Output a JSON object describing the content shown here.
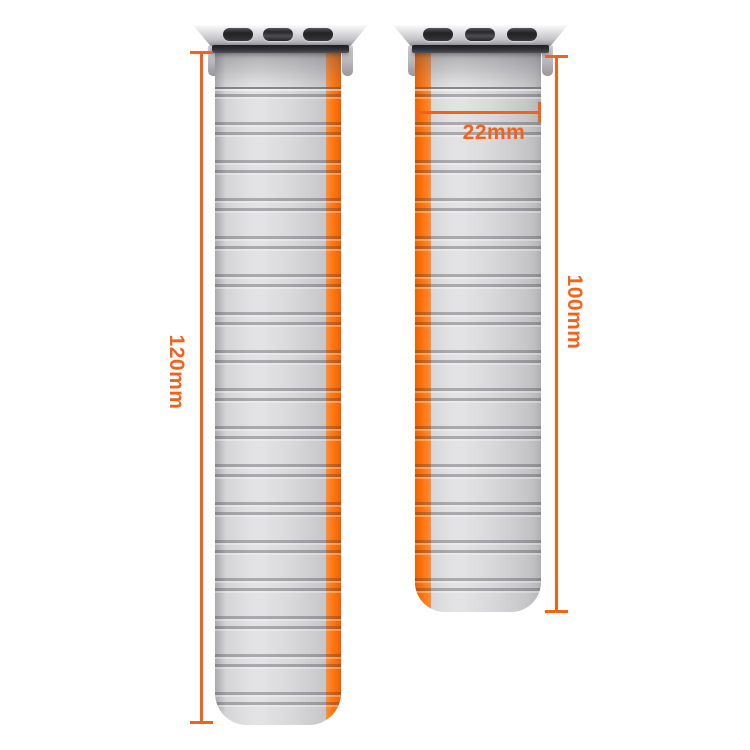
{
  "annotations": {
    "left_band_length": "120mm",
    "right_band_length": "100mm",
    "band_width": "22mm"
  },
  "colors": {
    "dimension_accent": "#f4621a",
    "stripe_orange": "#fd7a16",
    "strap_gray": "#d7d7d9",
    "adapter_silver": "#d2d2d6",
    "slot_black": "#2a2a2c",
    "background": "#ffffff"
  }
}
